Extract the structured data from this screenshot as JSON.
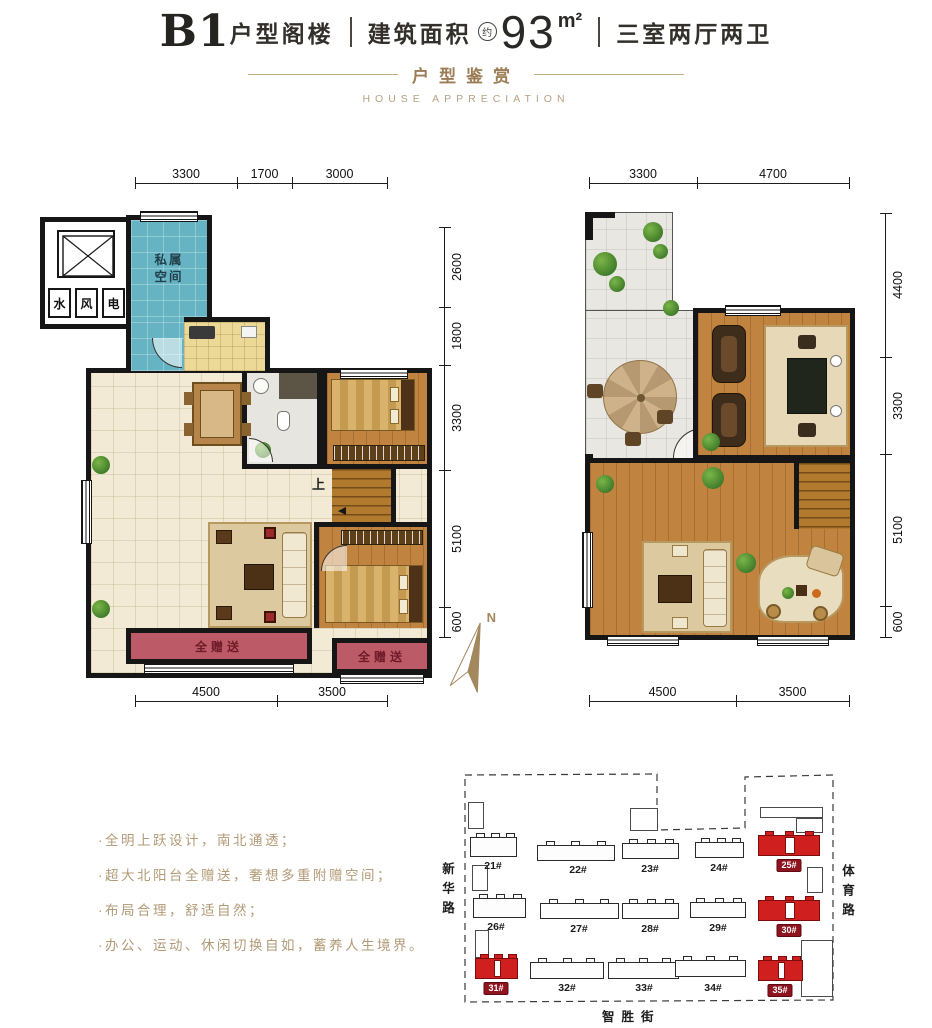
{
  "header": {
    "unit_code": "B1",
    "unit_name": "户型阁楼",
    "area_label": "建筑面积",
    "area_circle": "约",
    "area_value": "93",
    "area_unit": "m²",
    "layout_desc": "三室两厅两卫",
    "section_title_cn": "户型鉴赏",
    "section_title_en": "HOUSE APPRECIATION"
  },
  "plan_lower": {
    "dims_top": [
      "3300",
      "1700",
      "3000"
    ],
    "dims_right": [
      "2600",
      "1800",
      "3300",
      "5100",
      "600"
    ],
    "dims_bottom": [
      "4500",
      "3500"
    ],
    "labels": {
      "private_space_l1": "私属",
      "private_space_l2": "空间",
      "shaft_water": "水",
      "shaft_wind": "风",
      "shaft_power": "电",
      "stairs_up": "上",
      "balcony_gift_a": "全赠送",
      "balcony_gift_b": "全赠送"
    }
  },
  "plan_upper": {
    "dims_top": [
      "3300",
      "4700"
    ],
    "dims_right": [
      "4400",
      "3300",
      "5100",
      "600"
    ],
    "dims_bottom": [
      "4500",
      "3500"
    ]
  },
  "compass": {
    "north": "N"
  },
  "selling_points": [
    "·全明上跃设计，南北通透；",
    "·超大北阳台全赠送，奢想多重附赠空间；",
    "·布局合理，舒适自然；",
    "·办公、运动、休闲切换自如，蓄养人生境界。"
  ],
  "sitemap": {
    "road_left": "新华路",
    "road_right": "体育路",
    "road_bottom": "智胜街",
    "buildings": [
      {
        "no": "21#",
        "highlight": false
      },
      {
        "no": "22#",
        "highlight": false
      },
      {
        "no": "23#",
        "highlight": false
      },
      {
        "no": "24#",
        "highlight": false
      },
      {
        "no": "25#",
        "highlight": true
      },
      {
        "no": "26#",
        "highlight": false
      },
      {
        "no": "27#",
        "highlight": false
      },
      {
        "no": "28#",
        "highlight": false
      },
      {
        "no": "29#",
        "highlight": false
      },
      {
        "no": "30#",
        "highlight": true
      },
      {
        "no": "31#",
        "highlight": true
      },
      {
        "no": "32#",
        "highlight": false
      },
      {
        "no": "33#",
        "highlight": false
      },
      {
        "no": "34#",
        "highlight": false
      },
      {
        "no": "35#",
        "highlight": true
      }
    ],
    "highlight_color": "#d01f1f",
    "badge_color": "#8e1420"
  },
  "colors": {
    "accent_gold": "#a98a63",
    "wall_black": "#161616",
    "private_space_teal": "#66b3c3",
    "balcony_rose": "#bd5a67",
    "wood_floor": "#c08440",
    "kitchen_yellow": "#ecd998",
    "tile_cream": "#f2ead4"
  }
}
